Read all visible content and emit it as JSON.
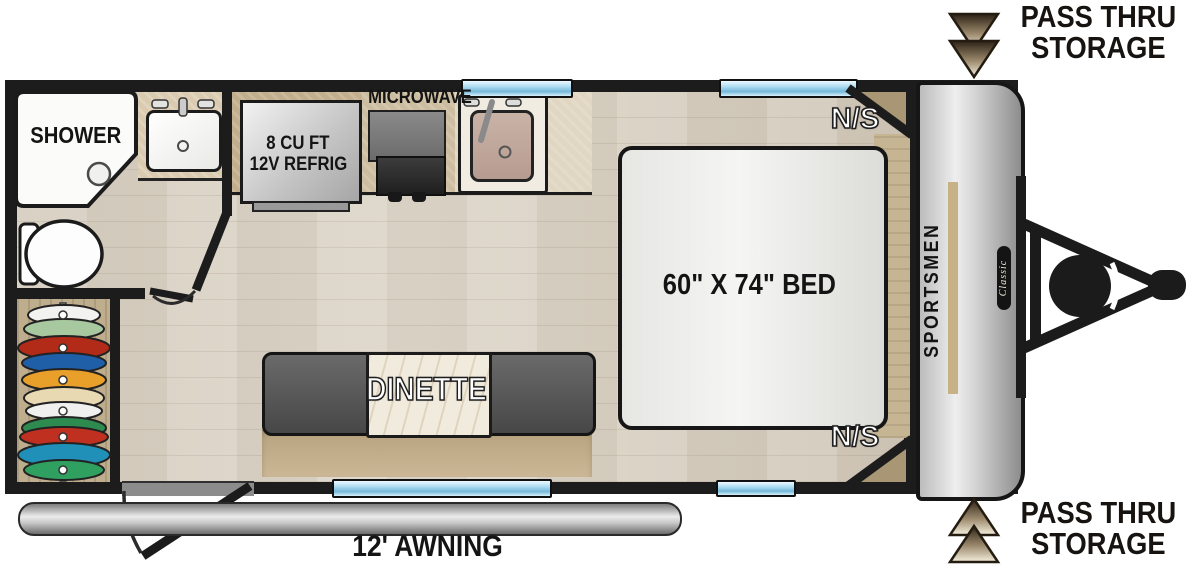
{
  "floorplan": {
    "brand": {
      "name": "SPORTSMEN",
      "series": "Classic"
    },
    "callouts": {
      "pass_thru_top": {
        "line1": "PASS THRU",
        "line2": "STORAGE"
      },
      "pass_thru_bottom": {
        "line1": "PASS THRU",
        "line2": "STORAGE"
      },
      "awning": "12' AWNING"
    },
    "bathroom": {
      "shower": "SHOWER"
    },
    "kitchen": {
      "refrig_line1": "8 CU FT",
      "refrig_line2": "12V REFRIG",
      "microwave": "MICROWAVE"
    },
    "bedroom": {
      "bed": "60\" X 74\" BED",
      "ns_top": "N/S",
      "ns_bottom": "N/S"
    },
    "dinette": {
      "label": "DINETTE"
    },
    "colors": {
      "wall": "#1c1c1c",
      "floor": "#d9d2c6",
      "counter": "#cfc0a3",
      "window_blue": "#a9daf1",
      "wood_dark": "#a89674",
      "bench_gray": "#5c5c5c",
      "arrow_dark": "#32271b",
      "arrow_light": "#f4eedd"
    }
  }
}
